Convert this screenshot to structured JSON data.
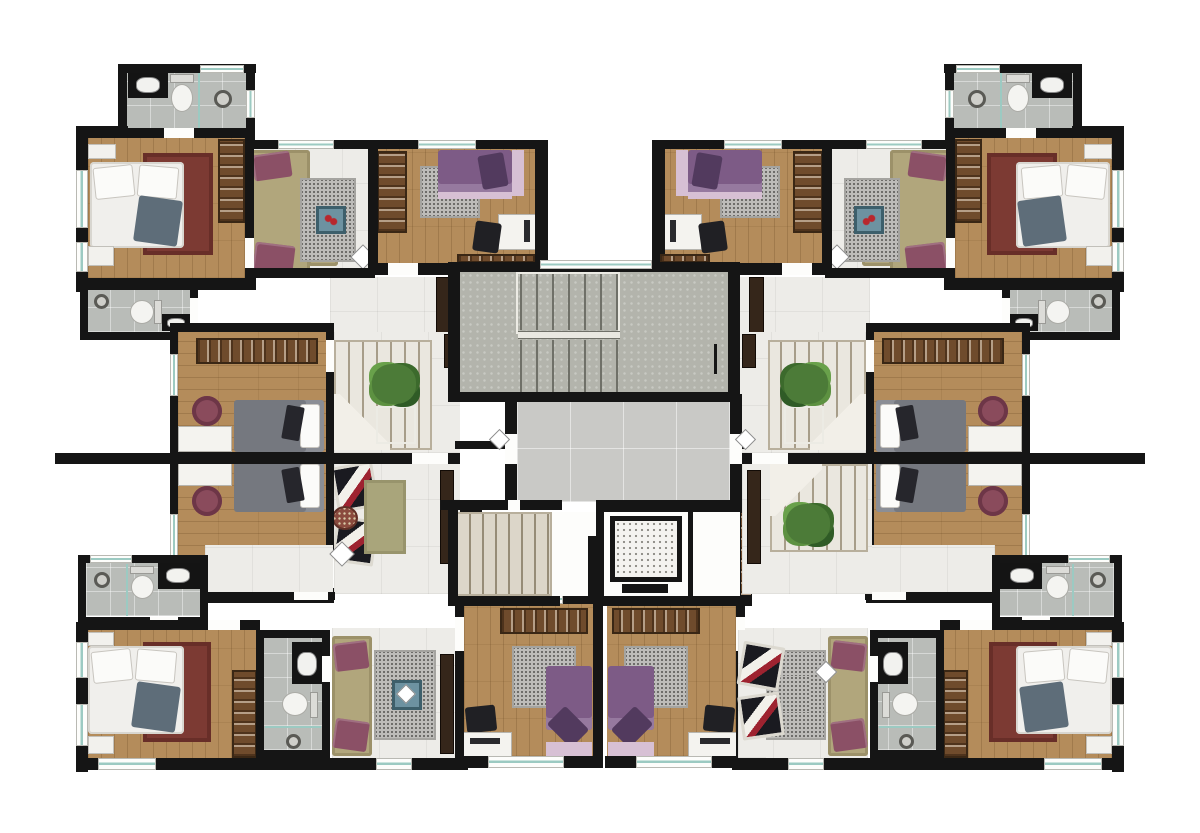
{
  "scene": {
    "type": "floor-plan",
    "description": "Top-down 3D architectural rendering of a residential apartment building floor with four corner units around a central core",
    "visible_text": []
  },
  "legend": {
    "unit_top_left": "Apartment unit - top left (bedroom, bathroom, living room, second bedroom)",
    "unit_middle_left": "Apartment unit - middle left (two bedrooms with desks, internal stair, lounge)",
    "unit_bottom_left": "Apartment unit - bottom left (bedroom, two bathrooms, living room, second bedroom)",
    "core": "Common core: main stairwell, hallway, service stair and elevator",
    "right_side": "Mirrored right-hand units",
    "patches": "Right-side furniture variations (internal stair and armchairs)"
  },
  "inventory": {
    "units_visible": 6,
    "bedrooms": 10,
    "bathrooms": 8,
    "double_beds_white": 4,
    "beds_gray": 4,
    "beds_purple": 4,
    "sofas": 4,
    "armchairs": 4,
    "desks": 10,
    "wardrobes": 12,
    "toilets": 8,
    "sinks": 8,
    "showers": 8,
    "plants": 3,
    "elevators": 1,
    "stair_flights": 6
  },
  "palette": {
    "bg": "#ffffff",
    "wall": "#151515",
    "wood": "#b48c5b",
    "tile": "#edece8",
    "hall": "#c9c9c6",
    "bath": "#b9bcb8",
    "concrete": "#b3b4ac",
    "teal": "#9ccac2",
    "rug-red": "#7c3a33",
    "rug-gray": "#bdbcb9",
    "rug-olive": "#a9a57b",
    "sofa": "#b1a67c",
    "maroon": "#8b5066",
    "bed-gray": "#75787f",
    "bed-purple": "#7d5b86",
    "pink": "#d7c0d4",
    "wardrobe": "#6f4b2c",
    "plant": "#4c7b38",
    "table-blue": "#6d92a1"
  }
}
